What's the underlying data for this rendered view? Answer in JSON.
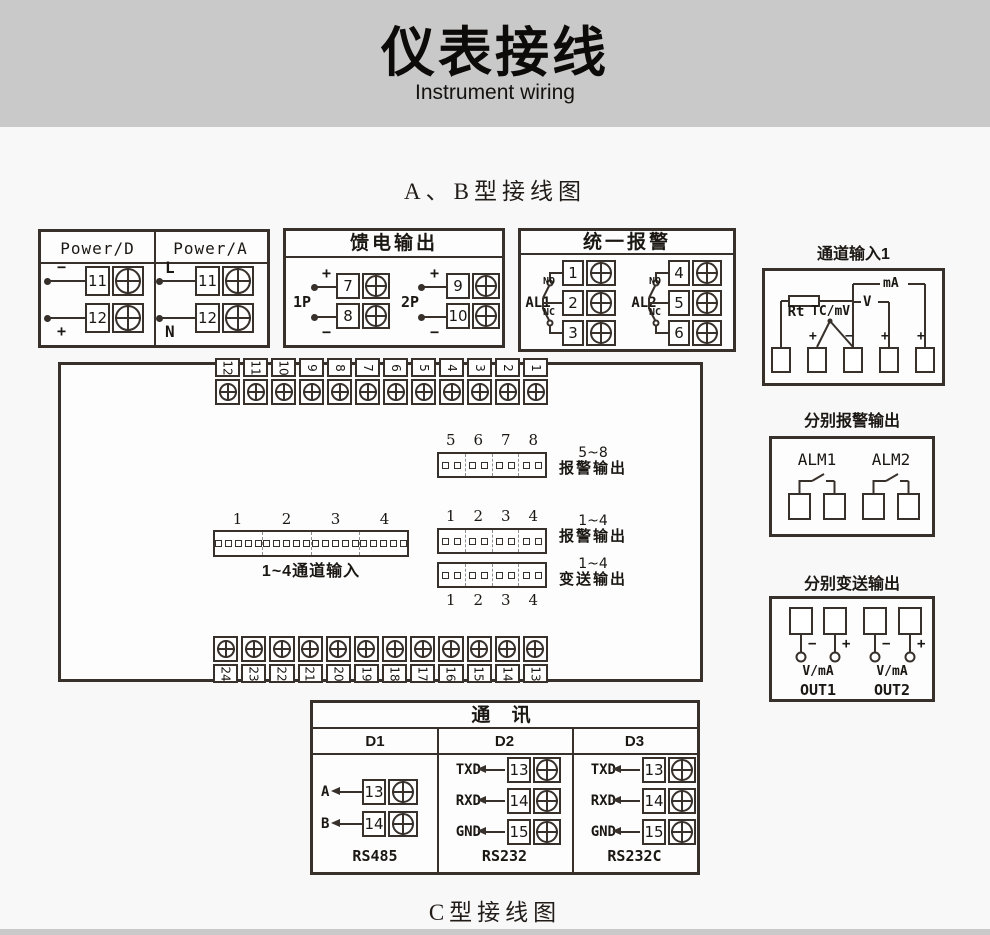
{
  "colors": {
    "ink": "#37302b",
    "banner_bg": "#c9c9c9",
    "page_bg": "#f8f8f8"
  },
  "banner": {
    "title": "仪表接线",
    "subtitle": "Instrument wiring"
  },
  "sections": {
    "ab_heading": "A、B型接线图",
    "c_heading": "C型接线图"
  },
  "power": {
    "headers": [
      "Power/D",
      "Power/A"
    ],
    "d": {
      "rows": [
        {
          "sign": "−",
          "num": "11"
        },
        {
          "sign": "+",
          "num": "12"
        }
      ]
    },
    "a": {
      "rows": [
        {
          "sign": "L",
          "num": "11"
        },
        {
          "sign": "N",
          "num": "12"
        }
      ]
    }
  },
  "feed": {
    "title": "馈电输出",
    "groups": [
      {
        "name": "1P",
        "rows": [
          {
            "sign": "+",
            "num": "7"
          },
          {
            "sign": "−",
            "num": "8"
          }
        ]
      },
      {
        "name": "2P",
        "rows": [
          {
            "sign": "+",
            "num": "9"
          },
          {
            "sign": "−",
            "num": "10"
          }
        ]
      }
    ]
  },
  "alarm": {
    "title": "统一报警",
    "groups": [
      {
        "name": "AL1",
        "no": "NO",
        "nc": "NC",
        "nums": [
          "1",
          "2",
          "3"
        ]
      },
      {
        "name": "AL2",
        "no": "NO",
        "nc": "NC",
        "nums": [
          "4",
          "5",
          "6"
        ]
      }
    ]
  },
  "channel1": {
    "title": "通道输入1",
    "labels": {
      "rt": "Rt",
      "tc": "TC/mV",
      "v": "V",
      "ma": "mA"
    },
    "signs": [
      "+",
      "−",
      "+",
      "+"
    ]
  },
  "board": {
    "top_terms": [
      "12",
      "11",
      "10",
      "9",
      "8",
      "7",
      "6",
      "5",
      "4",
      "3",
      "2",
      "1"
    ],
    "bottom_terms": [
      "24",
      "23",
      "22",
      "21",
      "20",
      "19",
      "18",
      "17",
      "16",
      "15",
      "14",
      "13"
    ],
    "alarm58": {
      "nums": [
        "5",
        "6",
        "7",
        "8"
      ],
      "cap1": "5~8",
      "cap2": "报警输出"
    },
    "chin": {
      "nums": [
        "1",
        "2",
        "3",
        "4"
      ],
      "caption": "1~4通道输入"
    },
    "alarm14": {
      "nums": [
        "1",
        "2",
        "3",
        "4"
      ],
      "cap1": "1~4",
      "cap2": "报警输出"
    },
    "trans14": {
      "nums": [
        "1",
        "2",
        "3",
        "4"
      ],
      "cap1": "1~4",
      "cap2": "变送输出"
    }
  },
  "sep_alarm": {
    "title": "分别报警输出",
    "groups": [
      "ALM1",
      "ALM2"
    ]
  },
  "sep_trans": {
    "title": "分别变送输出",
    "outs": [
      {
        "minus": "−",
        "plus": "+",
        "vma": "V/mA",
        "name": "OUT1"
      },
      {
        "minus": "−",
        "plus": "+",
        "vma": "V/mA",
        "name": "OUT2"
      }
    ]
  },
  "comm": {
    "title": "通 讯",
    "cols": [
      {
        "header": "D1",
        "rows": [
          {
            "label": "A",
            "num": "13"
          },
          {
            "label": "B",
            "num": "14"
          }
        ],
        "std": "RS485"
      },
      {
        "header": "D2",
        "rows": [
          {
            "label": "TXD",
            "num": "13"
          },
          {
            "label": "RXD",
            "num": "14"
          },
          {
            "label": "GND",
            "num": "15"
          }
        ],
        "std": "RS232"
      },
      {
        "header": "D3",
        "rows": [
          {
            "label": "TXD",
            "num": "13"
          },
          {
            "label": "RXD",
            "num": "14"
          },
          {
            "label": "GND",
            "num": "15"
          }
        ],
        "std": "RS232C"
      }
    ]
  }
}
